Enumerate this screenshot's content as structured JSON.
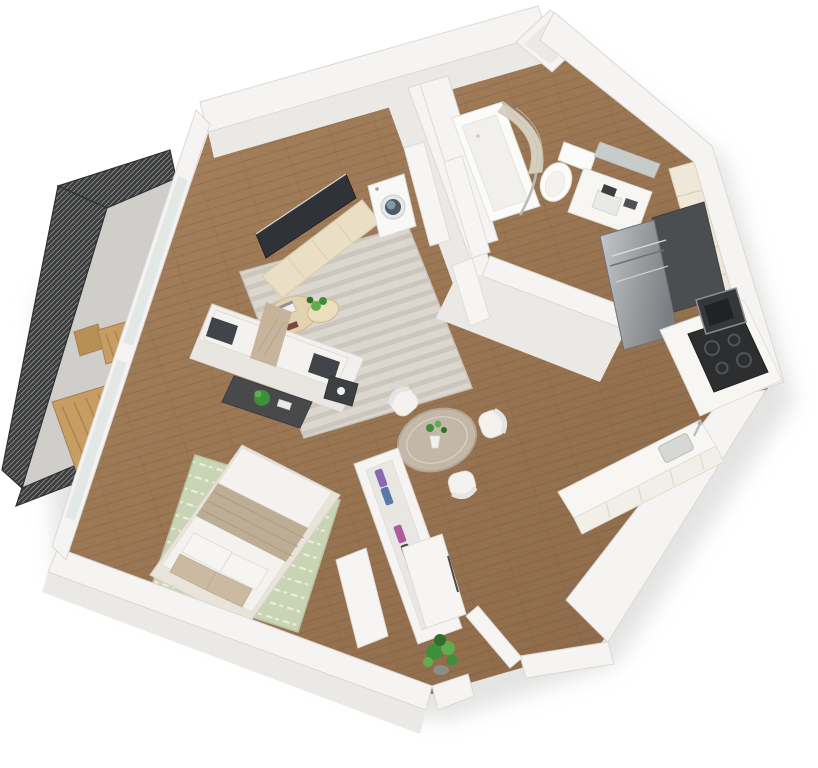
{
  "scene": {
    "type": "3d-floorplan-render",
    "description": "Isometric 3D render of a studio apartment floor plan on a white background",
    "rooms": [
      {
        "name": "balcony",
        "items": [
          "mesh-railing",
          "concrete-floor",
          "wood-bench",
          "wood-chair",
          "wood-side-table"
        ]
      },
      {
        "name": "living-room",
        "items": [
          "tv",
          "media-credenza",
          "sofa",
          "dark-pillows",
          "throw-blanket",
          "coffee-table",
          "nesting-tables",
          "laptop",
          "side-table",
          "striped-area-rug",
          "window-wall"
        ]
      },
      {
        "name": "sleeping-area",
        "items": [
          "double-bed",
          "green-dashed-rug",
          "white-pillows",
          "beige-pillows",
          "beige-blanket",
          "bed-bench"
        ]
      },
      {
        "name": "laundry-closet",
        "items": [
          "washing-machine",
          "closet-door"
        ]
      },
      {
        "name": "bathroom",
        "items": [
          "bathtub",
          "curved-shower-rod",
          "shower-curtain",
          "toilet",
          "vanity-sink",
          "mirror",
          "bathroom-doors"
        ]
      },
      {
        "name": "kitchen",
        "items": [
          "refrigerator",
          "upper-cabinets",
          "tall-dark-cabinet",
          "cooktop-oven",
          "microwave",
          "counter-peninsula",
          "sink",
          "faucet"
        ]
      },
      {
        "name": "dining-area",
        "items": [
          "round-glass-table",
          "white-chairs",
          "table-plant"
        ]
      },
      {
        "name": "entry",
        "items": [
          "entry-door",
          "floor-plant",
          "wardrobe",
          "wardrobe-clothes",
          "closet-panels"
        ]
      }
    ]
  },
  "palette": {
    "bg": "#ffffff",
    "shadow": "#cfcecc",
    "wallTop": "#f5f4f2",
    "wallFace": "#ebe9e6",
    "wallEdge": "#dbd9d5",
    "wood1": "#a8835e",
    "wood2": "#8a6747",
    "plankLine": "#5a3c23",
    "concrete": "#cfcecb",
    "railDark": "#3b3d3f",
    "railMesh": "#9a9a98",
    "railFrame": "#2e3032",
    "rugLight": "#dbd7cf",
    "rugStripe": "#ccc7be",
    "rugGreen": "#c8d4b4",
    "rugGreenStripe": "#e9efdc",
    "sofaWhite": "#f2f0ec",
    "sofaShade": "#e9e6e1",
    "cushionDark": "#414448",
    "throwBeige": "#c4b298",
    "tableDark": "#47494b",
    "woodTan": "#c89d63",
    "woodTanDark": "#a87f4e",
    "cream": "#eadfc5",
    "tvDark": "#2f3337",
    "washerWhite": "#f8f8f7",
    "washerGlass": "#4b5a66",
    "washerBlue": "#8aa3b4",
    "fixtureWhite": "#fbfbfa",
    "curtain": "#d9d2c2",
    "chrome": "#b9bcbf",
    "steel1": "#c6c9cc",
    "steel2": "#7b7e82",
    "steelDark": "#55585c",
    "applianceBlack": "#2c2e30",
    "burner": "#515457",
    "cabinetCream": "#efe8d9",
    "counterWhite": "#f7f6f3",
    "glassTable": "#cfc9bd",
    "chairWhite": "#f3f2ef",
    "plantGreen": "#3e8f3b",
    "plantGreen2": "#5fae4e",
    "plantDark": "#2e6f2c",
    "doorWhite": "#f6f5f3",
    "glassWin": "#e3e7e5",
    "mirror": "#ccd6d8",
    "bedWhite": "#f4f2ee",
    "blanket": "#bdad94",
    "pillowBeige": "#cbb9a2",
    "bedBase": "#e9e4da",
    "clothes1": "#8a68b0",
    "clothes2": "#5a79a8",
    "clothes3": "#b05a9e",
    "clothes4": "#6cae54",
    "clothes5": "#e8e6e2",
    "clothes6": "#474b52"
  }
}
